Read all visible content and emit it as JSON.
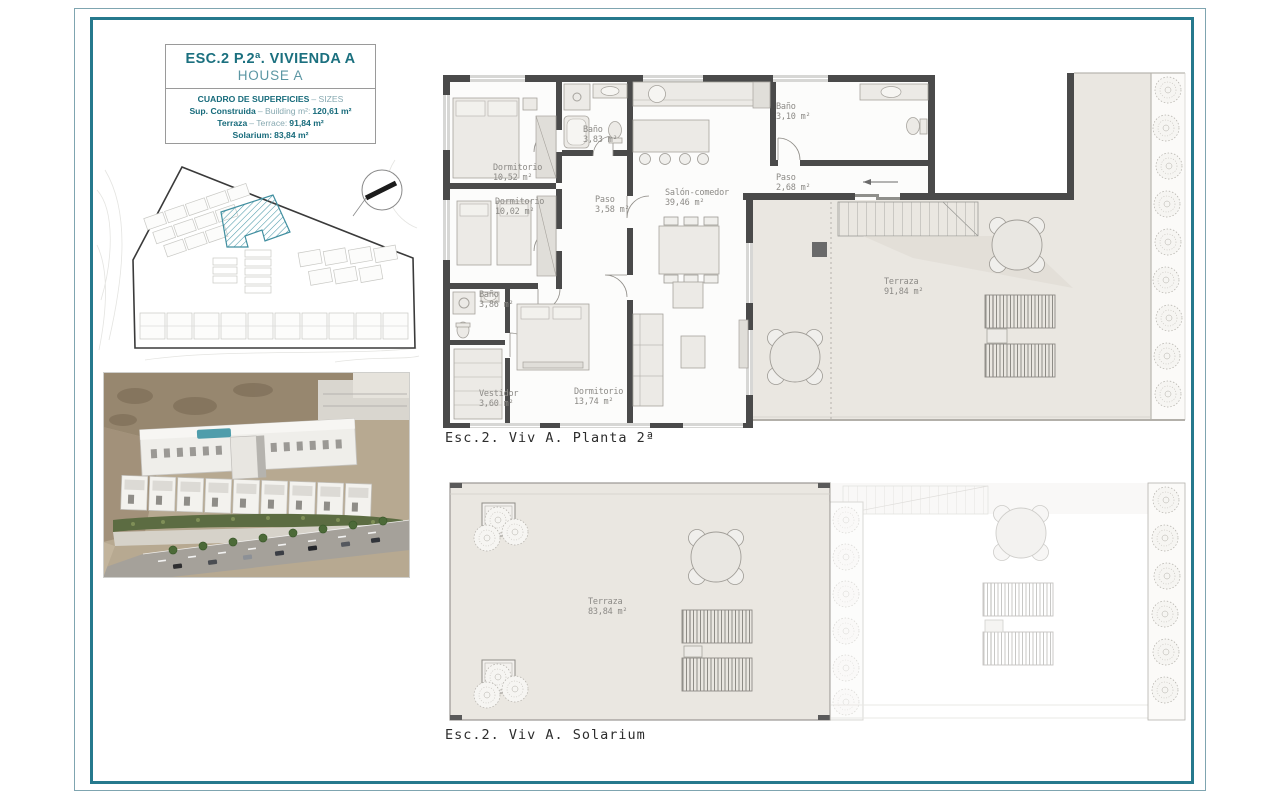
{
  "title_block": {
    "line1": "ESC.2 P.2ª. VIVIENDA A",
    "line2": "HOUSE A",
    "header": {
      "bold": "CUADRO DE SUPERFICIES",
      "light": "– SIZES"
    },
    "rows": [
      {
        "bold": "Sup. Construida",
        "light": "– Building m²:",
        "value": "120,61 m²"
      },
      {
        "bold": "Terraza",
        "light": "– Terrace:",
        "value": "91,84 m²"
      },
      {
        "bold": "Solarium:",
        "light": "",
        "value": "83,84 m²"
      }
    ]
  },
  "plans": {
    "planta2": {
      "caption": "Esc.2. Viv A. Planta 2ª",
      "rooms": [
        {
          "name": "Dormitorio",
          "area": "10,52 m²"
        },
        {
          "name": "Dormitorio",
          "area": "10,02 m²"
        },
        {
          "name": "Baño",
          "area": "3,83 m²"
        },
        {
          "name": "Paso",
          "area": "3,58 m²"
        },
        {
          "name": "Salón-comedor",
          "area": "39,46 m²"
        },
        {
          "name": "Baño",
          "area": "3,10 m²"
        },
        {
          "name": "Paso",
          "area": "2,68 m²"
        },
        {
          "name": "Baño",
          "area": "3,86 m²"
        },
        {
          "name": "Vestidor",
          "area": "3,60 m²"
        },
        {
          "name": "Dormitorio",
          "area": "13,74 m²"
        },
        {
          "name": "Terraza",
          "area": "91,84 m²"
        }
      ]
    },
    "solarium": {
      "caption": "Esc.2. Viv A. Solarium",
      "rooms": [
        {
          "name": "Terraza",
          "area": "83,84 m²"
        }
      ]
    }
  },
  "icons": {
    "north_arrow": "north-arrow"
  },
  "colors": {
    "accent_teal": "#1b707f",
    "border_teal": "#26798d",
    "hatch_teal": "#4b98a8",
    "wall_gray": "#4a4a4a",
    "terrace_beige": "#eae7e1"
  }
}
